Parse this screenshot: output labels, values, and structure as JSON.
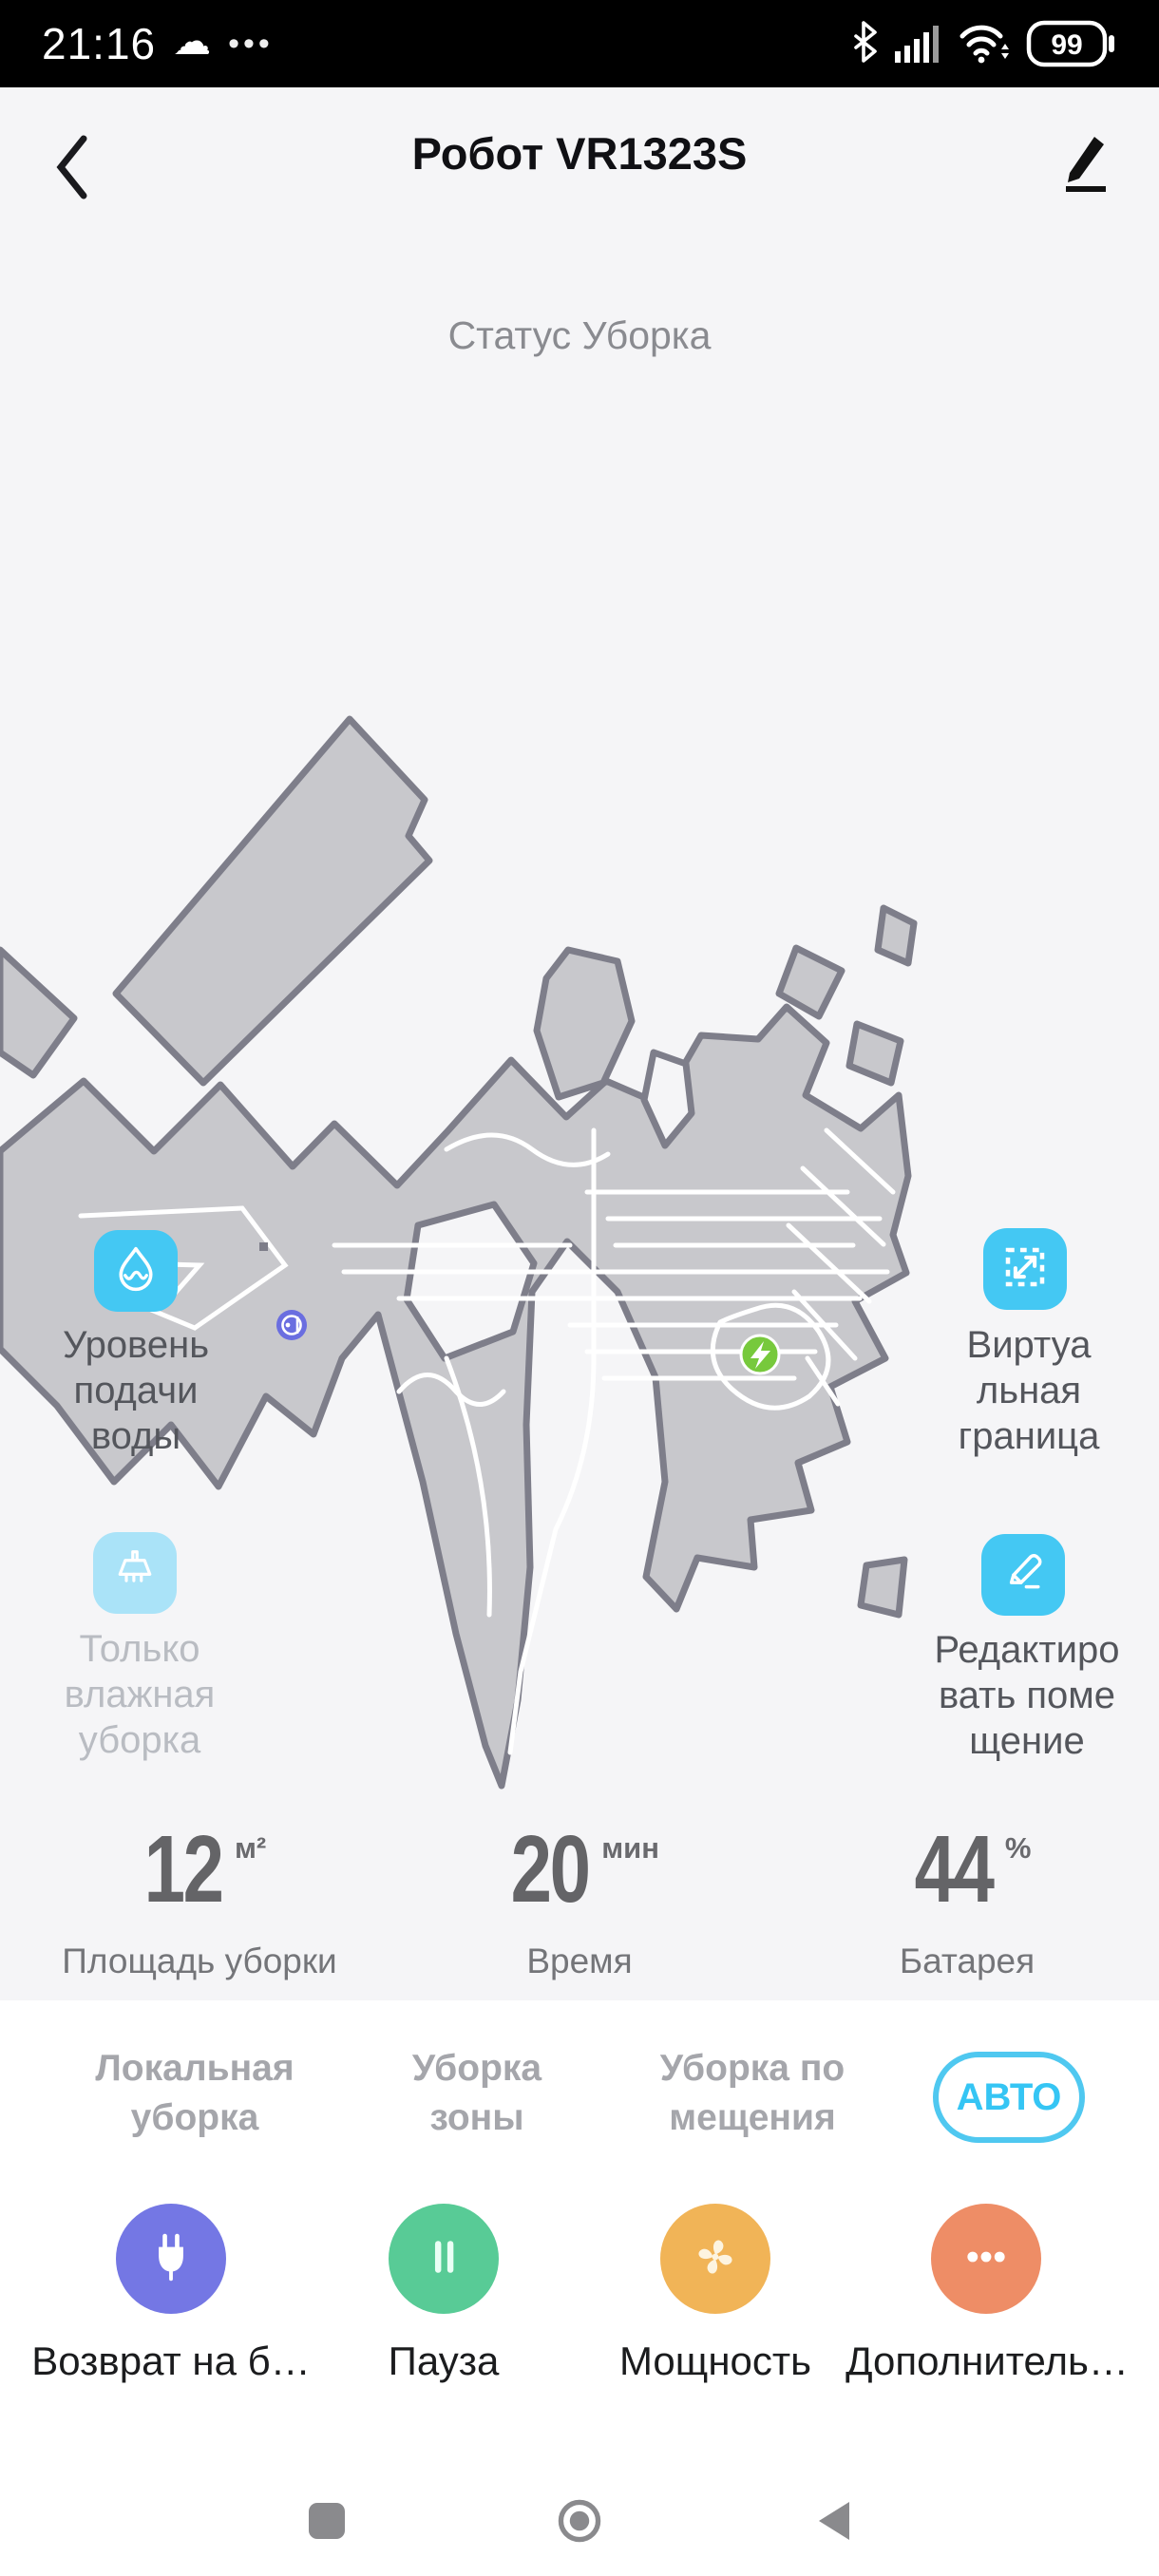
{
  "status_bar": {
    "time": "21:16",
    "battery_percent": "99",
    "icons": [
      "cloud",
      "more-dots",
      "bluetooth",
      "signal-bars",
      "wifi",
      "battery"
    ]
  },
  "header": {
    "title": "Робот VR1323S"
  },
  "status": {
    "label": "Статус Уборка"
  },
  "map": {
    "markers": {
      "robot": "robot-position",
      "dock": "charging-dock"
    },
    "colors": {
      "floor": "#c8c8cc",
      "border": "#7e7e8a",
      "clean_path": "#ffffff",
      "robot": "#6a6ee0",
      "dock": "#77c93c"
    }
  },
  "side_controls": {
    "water_level": {
      "label": "Уровень\nподачи\nводы",
      "enabled": true
    },
    "virtual_boundary": {
      "label": "Виртуа\nльная\nграница",
      "enabled": true
    },
    "wet_only": {
      "label": "Только\nвлажная\nуборка",
      "enabled": false
    },
    "edit_room": {
      "label": "Редактиро\nвать поме\nщение",
      "enabled": true
    }
  },
  "stats": {
    "area": {
      "value": "12",
      "unit": "м²",
      "label": "Площадь уборки"
    },
    "time": {
      "value": "20",
      "unit": "мин",
      "label": "Время"
    },
    "battery": {
      "value": "44",
      "unit": "%",
      "label": "Батарея"
    }
  },
  "modes": {
    "items": [
      {
        "label": "Локальная\nуборка",
        "active": false
      },
      {
        "label": "Уборка\nзоны",
        "active": false
      },
      {
        "label": "Уборка по\nмещения",
        "active": false
      },
      {
        "label": "АВТО",
        "active": true
      }
    ]
  },
  "actions": {
    "items": [
      {
        "label": "Возврат на б…",
        "icon": "plug-icon",
        "color": "#7477e4"
      },
      {
        "label": "Пауза",
        "icon": "pause-icon",
        "color": "#58cb96"
      },
      {
        "label": "Мощность",
        "icon": "fan-icon",
        "color": "#f1b457"
      },
      {
        "label": "Дополнитель…",
        "icon": "more-dots-icon",
        "color": "#ee8d66"
      }
    ]
  },
  "navbar": {
    "icons": [
      "recents-square",
      "home-circle",
      "back-triangle"
    ]
  },
  "colors": {
    "accent_cyan": "#44c8f3",
    "disabled_cyan": "#aae3f8",
    "active_pill": "#4fc8f0",
    "page_bg": "#f5f5f7",
    "sheet_bg": "#ffffff",
    "statusbar_bg": "#000000"
  }
}
